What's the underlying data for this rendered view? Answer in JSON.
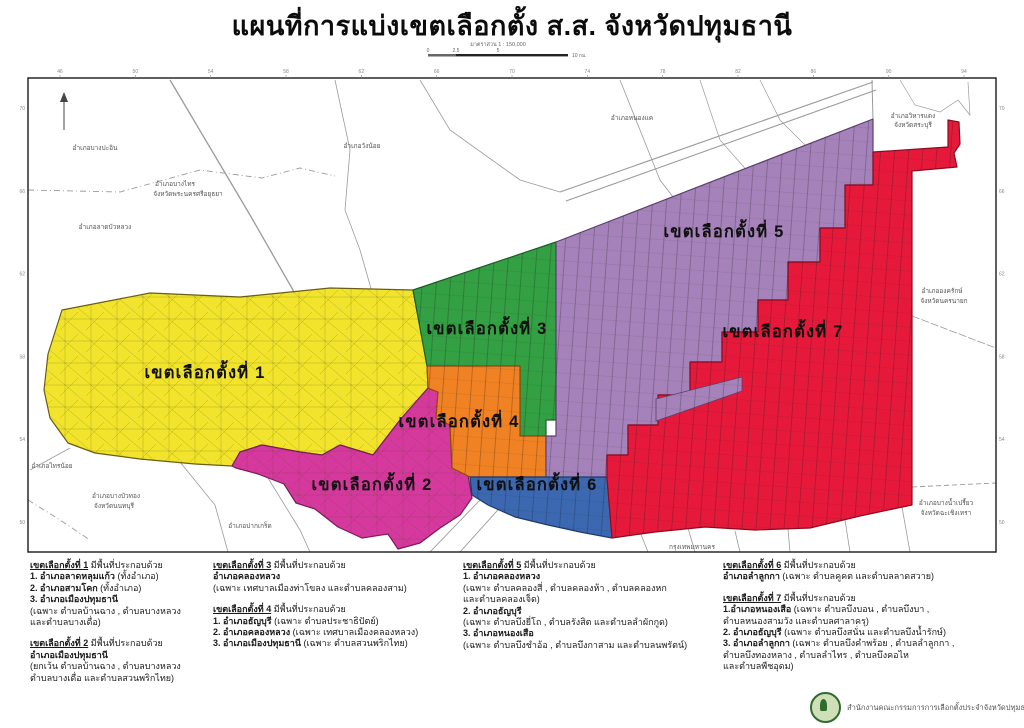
{
  "title": "แผนที่การแบ่งเขตเลือกตั้ง ส.ส. จังหวัดปทุมธานี",
  "scale_bar": {
    "caption": "มาตราส่วน 1 : 150,000",
    "tick0": "0",
    "tick1": "2.5",
    "tick2": "5",
    "tick_end": "10 กม."
  },
  "map": {
    "frame": {
      "x": 28,
      "y": 78,
      "w": 968,
      "h": 474
    },
    "ticks_top": [
      "46",
      "50",
      "54",
      "58",
      "62",
      "66",
      "70",
      "74",
      "78",
      "82",
      "86",
      "90",
      "94"
    ],
    "ticks_left": [
      "70",
      "66",
      "62",
      "58",
      "54",
      "50"
    ],
    "ticks_right": [
      "70",
      "66",
      "62",
      "58",
      "54",
      "50"
    ],
    "districts": [
      {
        "id": 1,
        "label": "เขตเลือกตั้งที่ 1",
        "color": "#f2e42d",
        "stroke": "#6b5d10",
        "points": "62,310 150,293 240,297 330,288 413,290 427,365 428,388 400,420 373,455 340,445 322,455 300,452 262,445 240,452 232,466 195,464 140,459 95,453 68,443 50,418 44,390 48,354",
        "lx": 205,
        "ly": 378,
        "pattern": "net"
      },
      {
        "id": 2,
        "label": "เขตเลือกตั้งที่ 2",
        "color": "#d6399e",
        "stroke": "#7c1a5c",
        "points": "428,388 438,392 436,418 450,425 452,468 468,475 472,498 460,515 440,528 420,543 398,549 388,534 362,538 338,527 315,509 296,503 284,484 258,474 236,468 232,466 240,452 262,445 300,452 322,455 340,445 373,455 400,420",
        "lx": 372,
        "ly": 490,
        "pattern": "net"
      },
      {
        "id": 3,
        "label": "เขตเลือกตั้งที่ 3",
        "color": "#33a043",
        "stroke": "#1c5c27",
        "points": "413,290 556,242 556,420 546,420 546,436 520,436 520,366 427,366",
        "lx": 487,
        "ly": 334,
        "pattern": "klong"
      },
      {
        "id": 4,
        "label": "เขตเลือกตั้งที่ 4",
        "color": "#f08224",
        "stroke": "#8f4a0c",
        "points": "427,366 520,366 520,436 546,436 546,477 470,477 452,468 450,425 436,418 438,392 428,388",
        "lx": 459,
        "ly": 427,
        "pattern": "klong"
      },
      {
        "id": 5,
        "label": "เขตเลือกตั้งที่ 5",
        "color": "#a583ba",
        "stroke": "#5c4070",
        "points": "556,242 873,119 873,185 845,185 845,228 820,228 820,262 788,262 788,300 758,300 758,332 722,332 722,362 690,362 690,395 658,395 658,425 628,425 628,455 607,455 607,478 546,478 546,436 556,436 556,420",
        "lx": 724,
        "ly": 237,
        "pattern": "klong"
      },
      {
        "id": 6,
        "label": "เขตเลือกตั้งที่ 6",
        "color": "#3b68b1",
        "stroke": "#1e3a6e",
        "points": "470,477 607,477 612,538 580,532 548,525 515,517 488,505 472,495",
        "lx": 537,
        "ly": 490,
        "pattern": "klong"
      },
      {
        "id": 7,
        "label": "เขตเลือกตั้งที่ 7",
        "color": "#e6193b",
        "stroke": "#8c0c20",
        "points": "873,152 948,147 948,120 959,122 960,144 954,153 957,167 912,171 912,505 860,516 810,528 755,530 705,527 655,532 612,538 607,478 607,455 628,455 628,425 658,425 658,395 690,395 690,362 722,362 722,332 758,332 758,300 788,300 788,262 820,262 820,228 845,228 845,185 873,185",
        "lx": 783,
        "ly": 337,
        "pattern": "klong"
      }
    ],
    "extra_shapes": [
      {
        "name": "district-5-corridor",
        "color": "#a583ba",
        "stroke": "#5c4070",
        "points": "656,399 742,377 742,391 656,421",
        "pattern": "klong"
      }
    ],
    "neighbor_labels": [
      {
        "t": "อำเภอบางปะอิน",
        "x": 95,
        "y": 150
      },
      {
        "t": "อำเภอบางไทร",
        "x": 175,
        "y": 186
      },
      {
        "t": "จังหวัดพระนครศรีอยุธยา",
        "x": 188,
        "y": 196
      },
      {
        "t": "อำเภอลาดบัวหลวง",
        "x": 105,
        "y": 229
      },
      {
        "t": "อำเภอวังน้อย",
        "x": 362,
        "y": 148
      },
      {
        "t": "อำเภอหนองแค",
        "x": 632,
        "y": 120
      },
      {
        "t": "อำเภอวิหารแดง",
        "x": 913,
        "y": 118
      },
      {
        "t": "จังหวัดสระบุรี",
        "x": 913,
        "y": 127
      },
      {
        "t": "อำเภอองครักษ์",
        "x": 942,
        "y": 293
      },
      {
        "t": "จังหวัดนครนายก",
        "x": 944,
        "y": 303
      },
      {
        "t": "อำเภอบางน้ำเปรี้ยว",
        "x": 946,
        "y": 505
      },
      {
        "t": "จังหวัดฉะเชิงเทรา",
        "x": 946,
        "y": 515
      },
      {
        "t": "อำเภอไทรน้อย",
        "x": 52,
        "y": 468
      },
      {
        "t": "อำเภอบางบัวทอง",
        "x": 116,
        "y": 498
      },
      {
        "t": "จังหวัดนนทบุรี",
        "x": 114,
        "y": 508
      },
      {
        "t": "อำเภอปากเกร็ด",
        "x": 250,
        "y": 528
      },
      {
        "t": "กรุงเทพมหานคร",
        "x": 692,
        "y": 549
      }
    ]
  },
  "legend": {
    "columns": [
      {
        "x": 30,
        "w": 180,
        "blocks": [
          {
            "title": "เขตเลือกตั้งที่ 1",
            "suffix": " มีพื้นที่ประกอบด้วย",
            "lines": [
              {
                "b": "1. อำเภอลาดหลุมแก้ว ",
                "t": "(ทั้งอำเภอ)"
              },
              {
                "b": "2. อำเภอสามโคก ",
                "t": "(ทั้งอำเภอ)"
              },
              {
                "b": "3. อำเภอเมืองปทุมธานี",
                "t": ""
              },
              {
                "b": "",
                "t": "(เฉพาะ ตำบลบ้านฉาง , ตำบลบางหลวง"
              },
              {
                "b": "",
                "t": "และตำบลบางเดื่อ)"
              }
            ]
          },
          {
            "title": "เขตเลือกตั้งที่ 2",
            "suffix": " มีพื้นที่ประกอบด้วย",
            "lines": [
              {
                "b": "อำเภอเมืองปทุมธานี",
                "t": ""
              },
              {
                "b": "",
                "t": "(ยกเว้น ตำบลบ้านฉาง , ตำบลบางหลวง"
              },
              {
                "b": "",
                "t": "ตำบลบางเดื่อ และตำบลสวนพริกไทย)"
              }
            ]
          }
        ]
      },
      {
        "x": 213,
        "w": 245,
        "blocks": [
          {
            "title": "เขตเลือกตั้งที่ 3",
            "suffix": " มีพื้นที่ประกอบด้วย",
            "lines": [
              {
                "b": "อำเภอคลองหลวง",
                "t": ""
              },
              {
                "b": "",
                "t": "(เฉพาะ เทศบาลเมืองท่าโขลง และตำบลคลองสาม)"
              }
            ]
          },
          {
            "title": "เขตเลือกตั้งที่ 4",
            "suffix": " มีพื้นที่ประกอบด้วย",
            "lines": [
              {
                "b": "1. อำเภอธัญบุรี ",
                "t": "(เฉพาะ ตำบลประชาธิปัตย์)"
              },
              {
                "b": "2. อำเภอคลองหลวง ",
                "t": "(เฉพาะ เทศบาลเมืองคลองหลวง)"
              },
              {
                "b": "3. อำเภอเมืองปทุมธานี ",
                "t": "(เฉพาะ ตำบลสวนพริกไทย)"
              }
            ]
          }
        ]
      },
      {
        "x": 463,
        "w": 250,
        "blocks": [
          {
            "title": "เขตเลือกตั้งที่ 5",
            "suffix": " มีพื้นที่ประกอบด้วย",
            "lines": [
              {
                "b": "1. อำเภอคลองหลวง",
                "t": ""
              },
              {
                "b": "",
                "t": "(เฉพาะ ตำบลคลองสี่ , ตำบลคลองห้า , ตำบลคลองหก"
              },
              {
                "b": "",
                "t": "และตำบลคลองเจ็ด)"
              },
              {
                "b": "2. อำเภอธัญบุรี",
                "t": ""
              },
              {
                "b": "",
                "t": "(เฉพาะ ตำบลบึงยี่โถ , ตำบลรังสิต และตำบลลำผักกูด)"
              },
              {
                "b": "3. อำเภอหนองเสือ",
                "t": ""
              },
              {
                "b": "",
                "t": "(เฉพาะ ตำบลบึงชำอ้อ , ตำบลบึงกาสาม และตำบลนพรัตน์)"
              }
            ]
          }
        ]
      },
      {
        "x": 723,
        "w": 275,
        "blocks": [
          {
            "title": "เขตเลือกตั้งที่ 6",
            "suffix": " มีพื้นที่ประกอบด้วย",
            "lines": [
              {
                "b": "อำเภอลำลูกกา ",
                "t": "(เฉพาะ ตำบลคูคต และตำบลลาดสวาย)"
              }
            ]
          },
          {
            "title": "เขตเลือกตั้งที่ 7",
            "suffix": " มีพื้นที่ประกอบด้วย",
            "lines": [
              {
                "b": "1.อำเภอหนองเสือ ",
                "t": "(เฉพาะ ตำบลบึงบอน , ตำบลบึงบา ,"
              },
              {
                "b": "",
                "t": "ตำบลหนองสามวัง และตำบลศาลาครุ)"
              },
              {
                "b": "2. อำเภอธัญบุรี ",
                "t": "(เฉพาะ ตำบลบึงสนั่น และตำบลบึงน้ำรักษ์)"
              },
              {
                "b": "3. อำเภอลำลูกกา ",
                "t": "(เฉพาะ ตำบลบึงคำพร้อย , ตำบลลำลูกกา ,"
              },
              {
                "b": "",
                "t": "ตำบลบึงทองหลาง , ตำบลลำไทร , ตำบลบึงคอไห"
              },
              {
                "b": "",
                "t": "และตำบลพืชอุดม)"
              }
            ]
          }
        ]
      }
    ]
  },
  "footer": {
    "org": "สำนักงานคณะกรรมการการเลือกตั้งประจำจังหวัดปทุมธานี"
  }
}
